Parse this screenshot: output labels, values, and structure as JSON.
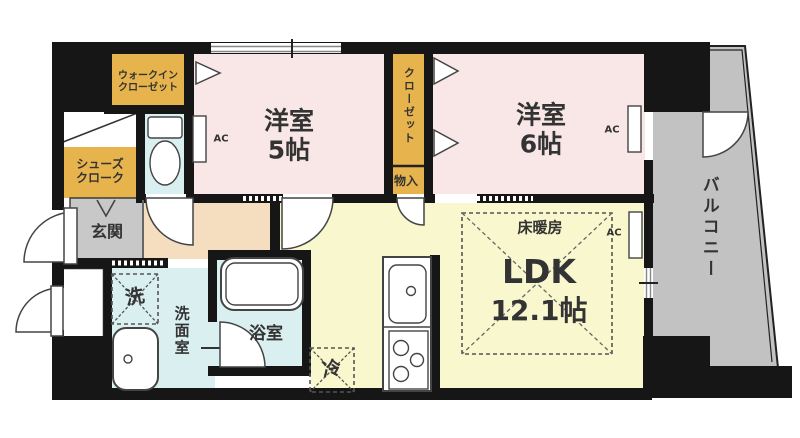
{
  "floorplan": {
    "rooms": {
      "western_room_5": {
        "name": "洋室",
        "size": "5帖"
      },
      "western_room_6": {
        "name": "洋室",
        "size": "6帖"
      },
      "ldk": {
        "name": "LDK",
        "size": "12.1帖",
        "floor_heating": "床暖房"
      },
      "walk_in_closet": {
        "line1": "ウォークイン",
        "line2": "クローゼット"
      },
      "shoe_closet": {
        "line1": "シューズ",
        "line2": "クローク"
      },
      "closet": {
        "label": "クローゼット"
      },
      "storage": {
        "label": "物入"
      },
      "entrance": {
        "label": "玄関"
      },
      "washroom": {
        "label": "洗面室"
      },
      "bathroom": {
        "label": "浴室"
      },
      "balcony": {
        "label": "バルコニー"
      }
    },
    "fixtures": {
      "washing_machine": {
        "label": "洗"
      },
      "refrigerator": {
        "label": "冷"
      },
      "air_conditioner": {
        "label": "AC"
      }
    },
    "colors": {
      "wall": "#161616",
      "western_room_pink": "#f8e7e6",
      "closet_mustard": "#e7b34c",
      "wet_area_cyan": "#daf0f0",
      "entrance_gray": "#c8c8c8",
      "balcony_gray": "#c2c2c2",
      "hallway_peach": "#f5ddc0",
      "ldk_yellow": "#f9f7cd",
      "text": "#333333"
    }
  }
}
